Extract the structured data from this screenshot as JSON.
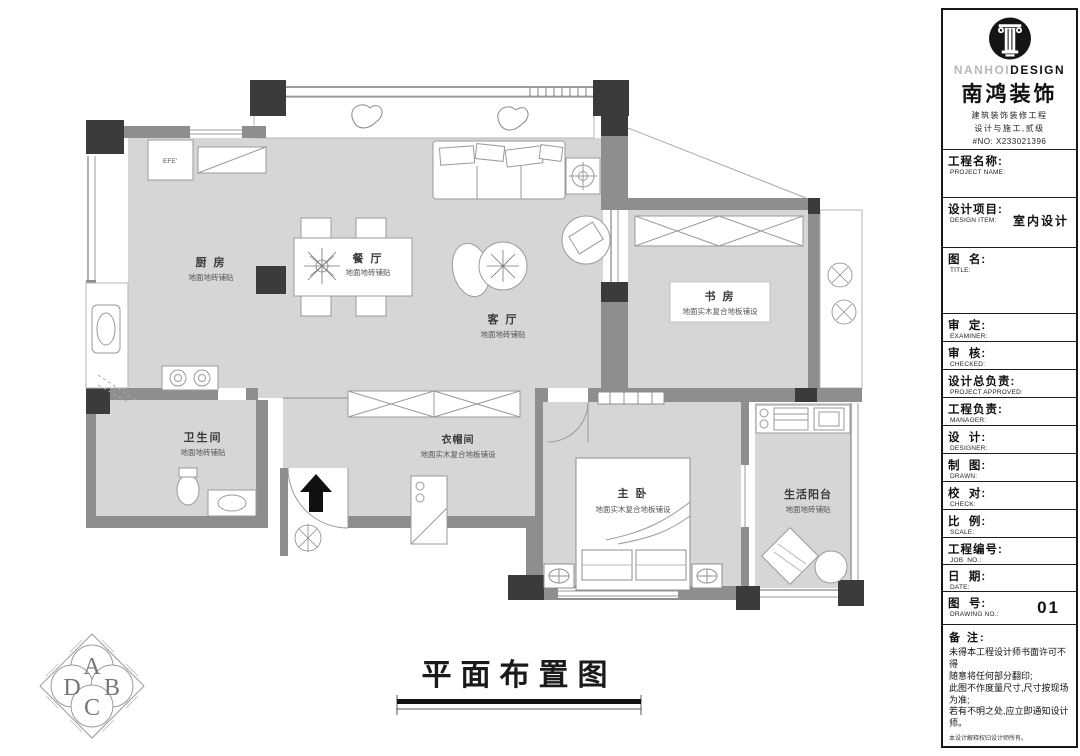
{
  "plan": {
    "title": "平面布置图",
    "cabinet_label": "EFE'",
    "rooms": [
      {
        "name": "厨  房",
        "finish": "地面地砖铺贴"
      },
      {
        "name": "餐  厅",
        "finish": "地面地砖铺贴"
      },
      {
        "name": "客  厅",
        "finish": "地面地砖铺贴"
      },
      {
        "name": "书  房",
        "finish": "地面实木复合地板铺设"
      },
      {
        "name": "卫生间",
        "finish": "地面地砖铺贴"
      },
      {
        "name": "衣帽间",
        "finish": "地面实木复合地板铺设"
      },
      {
        "name": "主  卧",
        "finish": "地面实木复合地板铺设"
      },
      {
        "name": "生活阳台",
        "finish": "地面地砖铺贴"
      }
    ],
    "index_symbol": {
      "top": "A",
      "left": "D",
      "right": "B",
      "bottom": "C"
    },
    "colors": {
      "floor": "#d6d6d6",
      "wall": "#8e8e8e",
      "column": "#3b3b3b"
    }
  },
  "titleblock": {
    "brand": {
      "latin_light": "NANHOI",
      "latin_bold": "DESIGN",
      "cn_name": "南鸿装饰",
      "subtitle1": "建筑装饰装修工程",
      "subtitle2": "设计与施工,贰级",
      "cert_no": "#NO: X233021396"
    },
    "fields": [
      {
        "cn": "工程名称:",
        "en": "PROJECT NAME:",
        "value": ""
      },
      {
        "cn": "设计项目:",
        "en": "DESIGN ITEM:",
        "value": "室内设计"
      },
      {
        "cn": "图  名:",
        "en": "TITLE:",
        "value": ""
      },
      {
        "cn": "审  定:",
        "en": "EXAMINER:",
        "value": ""
      },
      {
        "cn": "审  核:",
        "en": "CHECKED:",
        "value": ""
      },
      {
        "cn": "设计总负责:",
        "en": "PROJECT APPROVED:",
        "value": ""
      },
      {
        "cn": "工程负责:",
        "en": "MANAGER:",
        "value": ""
      },
      {
        "cn": "设  计:",
        "en": "DESIGNER:",
        "value": ""
      },
      {
        "cn": "制  图:",
        "en": "DRAWN:",
        "value": ""
      },
      {
        "cn": "校  对:",
        "en": "CHECK:",
        "value": ""
      },
      {
        "cn": "比  例:",
        "en": "SCALE:",
        "value": ""
      },
      {
        "cn": "工程编号:",
        "en": "JOB  NO.:",
        "value": ""
      },
      {
        "cn": "日  期:",
        "en": "DATE:",
        "value": ""
      },
      {
        "cn": "图  号:",
        "en": "DRAWING NO.:",
        "value": "01"
      }
    ],
    "notes": {
      "label": "备 注:",
      "body": "未得本工程设计师书面许可不得\n随意将任何部分翻印;\n此图不作度量尺寸,尺寸按现场\n为准;\n若有不明之处,应立即通知设计\n师。",
      "fine_print": "本设计解释权归设计师所有。",
      "phone": "免费质量监督电话:400 8383 168"
    }
  }
}
